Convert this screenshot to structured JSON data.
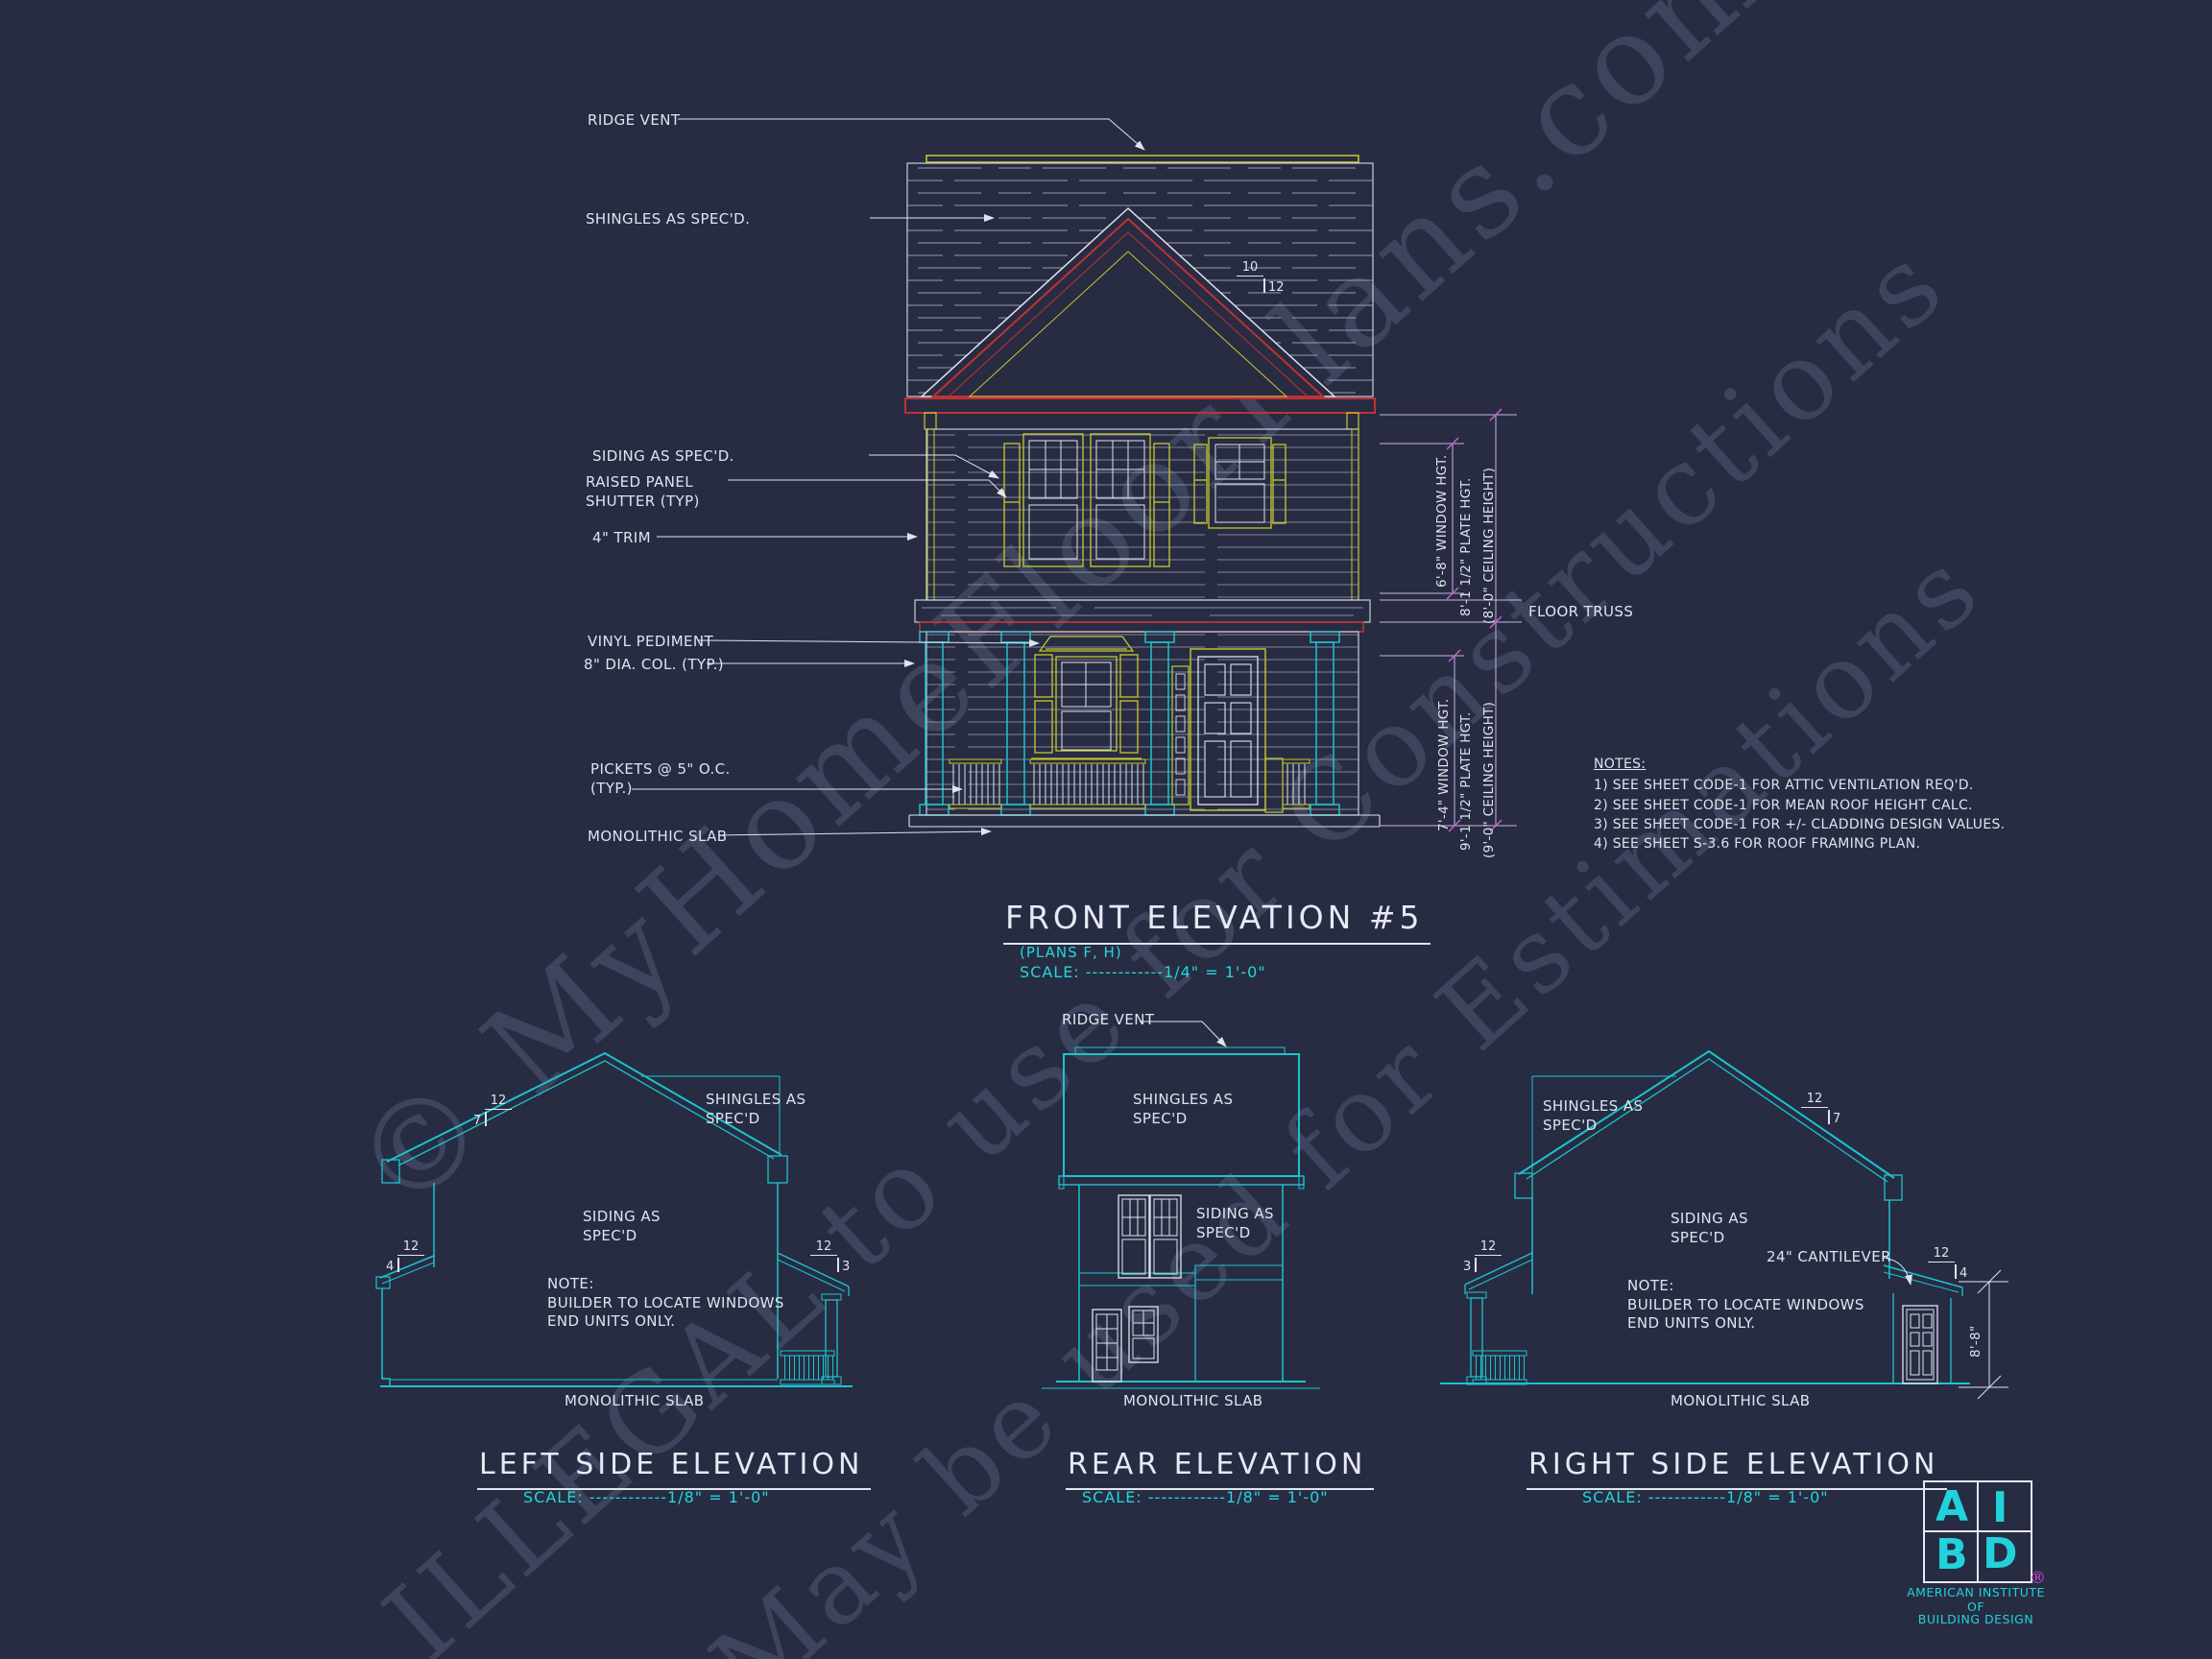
{
  "watermark": {
    "line1": "© MyHomeFloorPlans.com",
    "line2": "ILLEGAL to use for Constructions",
    "line3": "May be used for Estimations"
  },
  "front": {
    "title": "FRONT ELEVATION #5",
    "plans": "(PLANS F, H)",
    "scale": "SCALE: ------------1/4\" = 1'-0\"",
    "labels": {
      "ridge_vent": "RIDGE VENT",
      "shingles": "SHINGLES AS SPEC'D.",
      "siding": "SIDING AS SPEC'D.",
      "shutter": "RAISED PANEL\nSHUTTER (TYP)",
      "trim": "4\" TRIM",
      "pediment": "VINYL PEDIMENT",
      "column": "8\" DIA. COL. (TYP.)",
      "pickets": "PICKETS @ 5\" O.C.\n(TYP.)",
      "slab": "MONOLITHIC SLAB",
      "floor_truss": "FLOOR TRUSS"
    },
    "pitch": {
      "top": "10",
      "side": "12"
    },
    "dims": {
      "window2": "6'-8\" WINDOW HGT.",
      "plate2": "8'-1 1/2\" PLATE HGT.",
      "ceiling2": "(8'-0\" CEILING HEIGHT)",
      "window1": "7'-4\" WINDOW HGT.",
      "plate1": "9'-1 1/2\" PLATE HGT.",
      "ceiling1": "(9'-0\" CEILING HEIGHT)"
    },
    "notes": {
      "heading": "NOTES:",
      "n1": "1)  SEE SHEET CODE-1 FOR ATTIC VENTILATION REQ'D.",
      "n2": "2)  SEE SHEET CODE-1 FOR MEAN ROOF HEIGHT CALC.",
      "n3": "3)  SEE SHEET CODE-1 FOR +/- CLADDING DESIGN VALUES.",
      "n4": "4)  SEE SHEET S-3.6 FOR ROOF FRAMING PLAN."
    }
  },
  "left": {
    "title": "LEFT SIDE ELEVATION",
    "scale": "SCALE: ------------1/8\" = 1'-0\"",
    "labels": {
      "shingles": "SHINGLES AS\nSPEC'D",
      "siding": "SIDING AS\nSPEC'D",
      "note": "NOTE:\nBUILDER TO LOCATE WINDOWS\nEND UNITS ONLY.",
      "slab": "MONOLITHIC SLAB"
    },
    "pitch_main": {
      "top": "12",
      "side": "7"
    },
    "pitch_shed": {
      "top": "12",
      "side": "4"
    },
    "pitch_porch": {
      "top": "12",
      "side": "3"
    }
  },
  "rear": {
    "title": "REAR ELEVATION",
    "scale": "SCALE: ------------1/8\" = 1'-0\"",
    "labels": {
      "ridge_vent": "RIDGE VENT",
      "shingles": "SHINGLES AS\nSPEC'D",
      "siding": "SIDING AS\nSPEC'D",
      "slab": "MONOLITHIC SLAB"
    }
  },
  "right": {
    "title": "RIGHT SIDE ELEVATION",
    "scale": "SCALE: ------------1/8\" = 1'-0\"",
    "labels": {
      "shingles": "SHINGLES AS\nSPEC'D",
      "siding": "SIDING AS\nSPEC'D",
      "cantilever": "24\" CANTILEVER",
      "note": "NOTE:\nBUILDER TO LOCATE WINDOWS\nEND UNITS ONLY.",
      "slab": "MONOLITHIC SLAB",
      "height_dim": "8'-8\""
    },
    "pitch_main": {
      "top": "12",
      "side": "7"
    },
    "pitch_shed": {
      "top": "12",
      "side": "4"
    },
    "pitch_porch": {
      "top": "12",
      "side": "3"
    }
  },
  "logo": {
    "a": "A",
    "i": "I",
    "b": "B",
    "d": "D",
    "reg": "®",
    "line1": "AMERICAN INSTITUTE",
    "line2": "OF",
    "line3": "BUILDING DESIGN"
  },
  "colors": {
    "background": "#272c42",
    "cyan": "#1cc3cf",
    "yellow": "#c9c92e",
    "red": "#c23036",
    "white_line": "#dfe4ee",
    "dim_line": "#cbb3dc",
    "tick_magenta": "#c75fd0"
  }
}
